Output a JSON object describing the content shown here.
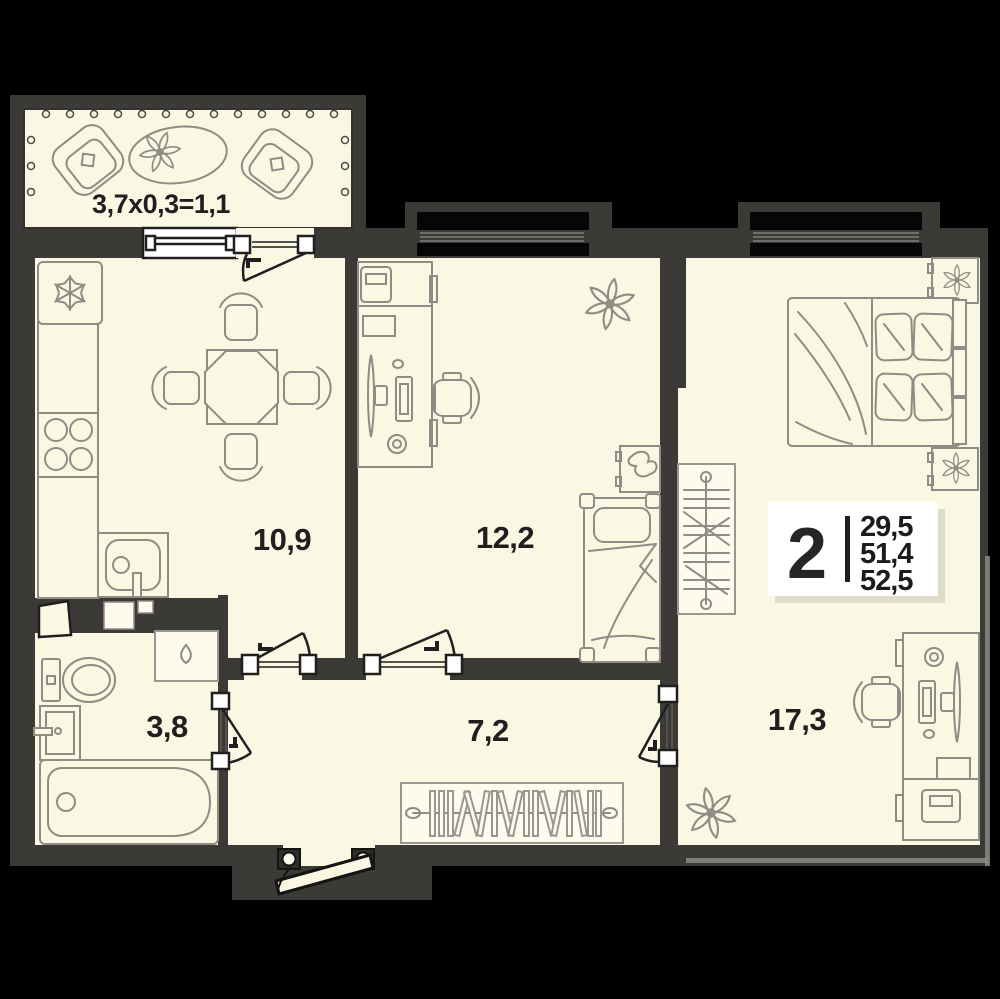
{
  "plan_type": "apartment-floor-plan",
  "balcony": {
    "label": "3,7x0,3=1,1"
  },
  "rooms": {
    "kitchen": {
      "area": "10,9"
    },
    "living": {
      "area": "12,2"
    },
    "bedroom": {
      "area": "17,3"
    },
    "bathroom": {
      "area": "3,8"
    },
    "hallway": {
      "area": "7,2"
    }
  },
  "badge": {
    "rooms_count": "2",
    "areas": [
      "29,5",
      "51,4",
      "52,5"
    ]
  },
  "colors": {
    "background": "#000000",
    "wall": "#3b3a37",
    "floor": "#faf7e2",
    "furniture_stroke": "#8f8c85",
    "door_stroke": "#1f1f1f",
    "badge_background": "#ffffff",
    "label_text": "#1f1f1f"
  }
}
